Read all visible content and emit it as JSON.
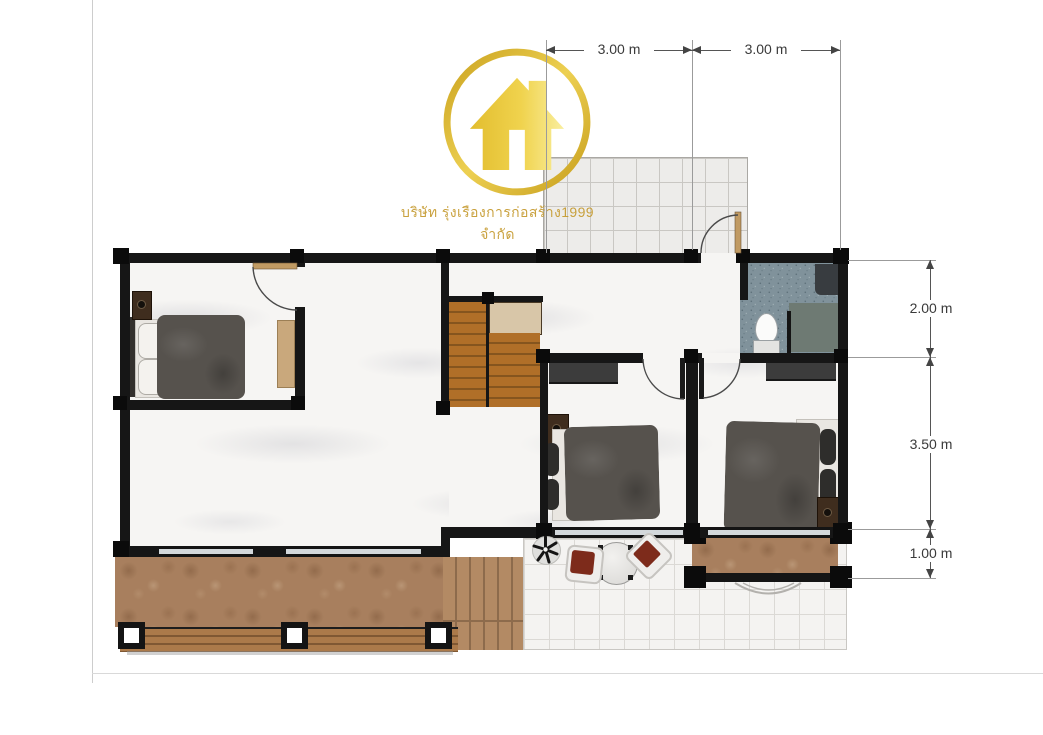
{
  "watermark": {
    "company_text": "บริษัท รุ่งเรืองการก่อสร้าง1999 จำกัด",
    "logo_icon": "house-in-gold-ring-icon",
    "gold_color": "#d9b32f",
    "text_color": "#c59a2e"
  },
  "dimensions": {
    "unit": "m",
    "top": [
      {
        "label": "3.00 m"
      },
      {
        "label": "3.00 m"
      }
    ],
    "right": [
      {
        "label": "2.00 m"
      },
      {
        "label": "3.50 m"
      },
      {
        "label": "1.00 m"
      }
    ],
    "line_color": "#555555",
    "text_color": "#3a3a3a"
  },
  "plan": {
    "type": "second-floor house plan, top view",
    "rooms_visible": 7,
    "colors": {
      "wall": "#161616",
      "marble_floor": "#f6f5f3",
      "bathroom_tile": "#80929b",
      "stair_wood": "#b06f28",
      "stair_landing": "#d8c6a8",
      "deck_stone": "#a87f5e",
      "wood_rail": "#ab7a4a",
      "patio_tile": "#f4f3f1",
      "bed_duvet": "#56524d",
      "chair_red": "#7d2b1b",
      "desk_tan": "#c9a87c"
    }
  }
}
